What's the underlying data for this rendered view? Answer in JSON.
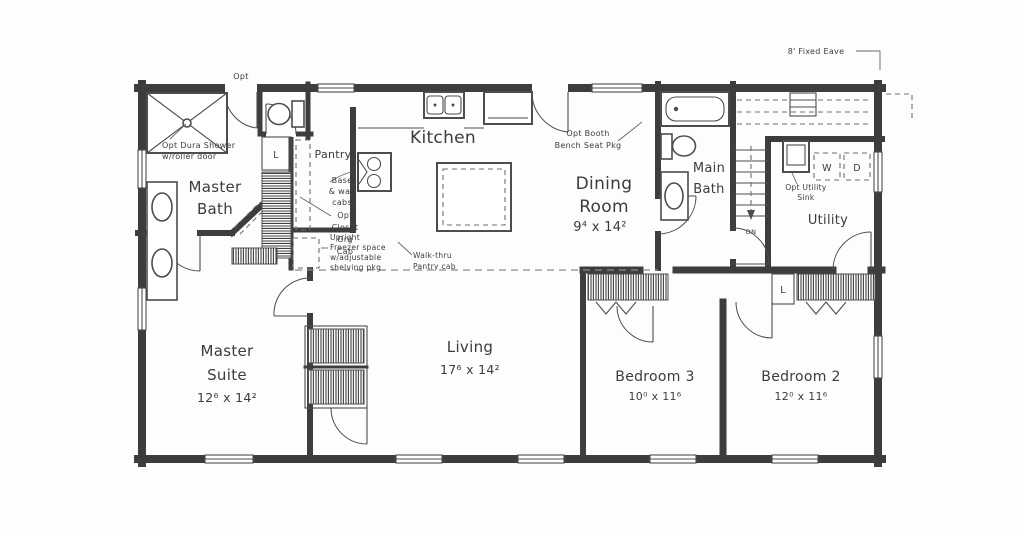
{
  "meta": {
    "type": "residential floor plan scan"
  },
  "rooms": {
    "master_bath": {
      "name_line1": "Master",
      "name_line2": "Bath"
    },
    "master_suite": {
      "name_line1": "Master",
      "name_line2": "Suite",
      "dims": "12⁶ x 14²"
    },
    "pantry": {
      "name": "Pantry"
    },
    "kitchen": {
      "name": "Kitchen"
    },
    "dining": {
      "name_line1": "Dining",
      "name_line2": "Room",
      "dims": "9⁴ x 14²"
    },
    "main_bath": {
      "name_line1": "Main",
      "name_line2": "Bath"
    },
    "utility": {
      "name": "Utility"
    },
    "living": {
      "name": "Living",
      "dims": "17⁶ x 14²"
    },
    "bedroom3": {
      "name": "Bedroom 3",
      "dims": "10⁰ x 11⁶"
    },
    "bedroom2": {
      "name": "Bedroom 2",
      "dims": "12⁰ x 11⁶"
    }
  },
  "annotations": {
    "fixed_eave": "8' Fixed Eave",
    "opt_door": "Opt",
    "shower": [
      "Opt Dura Shower",
      "w/roller door"
    ],
    "pantry_cabs": [
      "Base",
      "& wall",
      "cabs"
    ],
    "closet_org": [
      "Opt",
      "Closet",
      "Org",
      "Cab"
    ],
    "freezer": [
      "Upright",
      "Freezer space",
      "w/adjustable",
      "shelving pkg"
    ],
    "walkthru": [
      "Walk-thru",
      "Pantry cab"
    ],
    "booth": [
      "Opt Booth",
      "Bench Seat Pkg"
    ],
    "utility_sink": [
      "Opt Utility",
      "Sink"
    ],
    "stairs_down": "DN",
    "washer": "W",
    "dryer": "D",
    "linen_master": "L",
    "linen_hall": "L"
  },
  "colors": {
    "background": "#fdfdfd",
    "wall": "#3d3d3d",
    "line": "#4d4d4d",
    "text": "#3c3c3c"
  }
}
